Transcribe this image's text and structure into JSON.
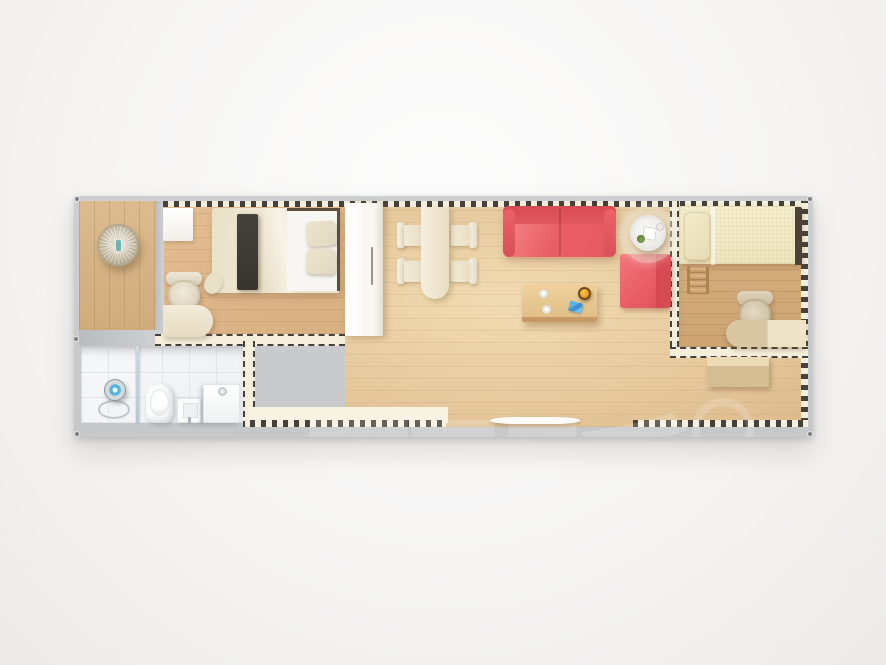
{
  "scene": {
    "description": "Top-down 3D rendering of a long rectangular prefab container-home floor plan with porch, master bedroom, bathroom, open living-dining area and a second bedroom",
    "watermark": {
      "text": "配跃",
      "style": "large translucent white glyphs with a faint ring mark over the side table"
    }
  },
  "palette": {
    "bg-hi": "#fdfdfd",
    "bg-mid": "#f6f5f4",
    "bg-lo": "#ebeae9",
    "frame": "#c6c8ca",
    "screw": "#7e8184",
    "wall-cream": "#f5eedc",
    "dash": "#46413a",
    "tile-line": "#e2e6ea",
    "sofa": "#ea5f66",
    "sofa-dark": "#d84b53",
    "watermark": "rgba(255,255,255,0.17)"
  },
  "plan": {
    "rooms": [
      {
        "name": "porch",
        "furniture": [
          "hanging-rattan-chair"
        ]
      },
      {
        "name": "master-bedroom",
        "furniture": [
          "double-bed",
          "dark-throw-runner",
          "pillows",
          "small-white-cabinet",
          "desk",
          "desk-chair"
        ]
      },
      {
        "name": "bathroom",
        "furniture": [
          "shower-fixture",
          "glass-divider",
          "toilet",
          "wash-basin",
          "washing-machine"
        ]
      },
      {
        "name": "living-dining",
        "furniture": [
          "tall-white-wardrobe",
          "dining-table",
          "dining-chairs-x4",
          "red-sofa",
          "red-armchair",
          "round-side-table",
          "round-rug",
          "wooden-coffee-table",
          "entry-door-sill"
        ]
      },
      {
        "name": "second-bedroom",
        "furniture": [
          "single-bed",
          "loft-ladder",
          "desk",
          "desk-chair",
          "low-cabinet"
        ]
      }
    ]
  }
}
